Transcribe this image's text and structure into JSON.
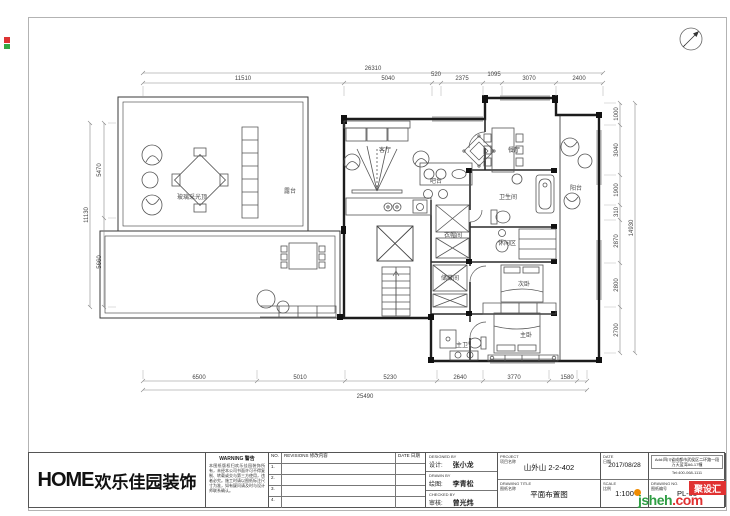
{
  "logo": {
    "home": "HOME",
    "cn": "欢乐佳园装饰"
  },
  "warning": {
    "title": "WARNING 警告",
    "body": "本图纸版权归欢乐佳园装饰所有，未经本公司书面许可不得复制、转载或交与第三方使用，违者必究。施工时请以图纸标注尺寸为准，如有疑问请及时与设计师联系确认。"
  },
  "revisions": {
    "no": "NO.",
    "title": "REVISIONS 修改内容",
    "date": "DATE 日期",
    "rows": [
      "1.",
      "2.",
      "3.",
      "4."
    ]
  },
  "credits": {
    "designed_en": "DESIGNED BY",
    "designed_cn": "设计:",
    "designed_name": "张小龙",
    "drawn_en": "DRAWN BY",
    "drawn_cn": "绘图:",
    "drawn_name": "李青松",
    "checked_en": "CHECKED BY",
    "checked_cn": "审核:",
    "checked_name": "曾光炜"
  },
  "project": {
    "label": "PROJECT",
    "label_cn": "项目名称",
    "value": "山外山 2-2-402"
  },
  "drawing_title": {
    "label": "DRAWING TITLE",
    "label_cn": "图纸名称",
    "value": "平面布置图"
  },
  "date": {
    "label": "DATE",
    "label_cn": "日期",
    "value": "2017/08/28"
  },
  "scale": {
    "label": "SCALE",
    "label_cn": "比例",
    "value": "1:100"
  },
  "address": {
    "line1": "Add:四川省成都市武侯区二环路一段",
    "line2": "万天蓝湾A6-17幢",
    "tel": "Tel:400-068-1111"
  },
  "drawing_no": {
    "label": "DRAWING NO.",
    "label_cn": "图纸编号",
    "value": "PL-05"
  },
  "watermark": {
    "site": "jsheh",
    "tld": ".com",
    "badge": "聚设汇",
    "green": "#2f9e44",
    "red": "#e03131",
    "orange": "#f08c00"
  },
  "dims": {
    "top": {
      "overall": "26310",
      "segments": [
        "11510",
        "5040",
        "520",
        "2375",
        "1095",
        "3070",
        "2400"
      ]
    },
    "bottom": {
      "overall": "25490",
      "segments": [
        "6500",
        "5010",
        "5230",
        "2640",
        "3770",
        "1580"
      ]
    },
    "left": {
      "overall": "11130",
      "segments": [
        "5470",
        "5660"
      ]
    },
    "right": {
      "overall": "14930",
      "segments": [
        "1000",
        "3040",
        "1900",
        "310",
        "2870",
        "2800",
        "2700"
      ]
    }
  },
  "rooms": [
    {
      "label": "玻璃采光顶"
    },
    {
      "label": "露台"
    },
    {
      "label": "客厅"
    },
    {
      "label": "吧台"
    },
    {
      "label": "餐厅"
    },
    {
      "label": "卫生间"
    },
    {
      "label": "阳台"
    },
    {
      "label": "休闲区"
    },
    {
      "label": "衣帽间"
    },
    {
      "label": "储藏间"
    },
    {
      "label": "次卧"
    },
    {
      "label": "主卫"
    },
    {
      "label": "主卧"
    }
  ]
}
